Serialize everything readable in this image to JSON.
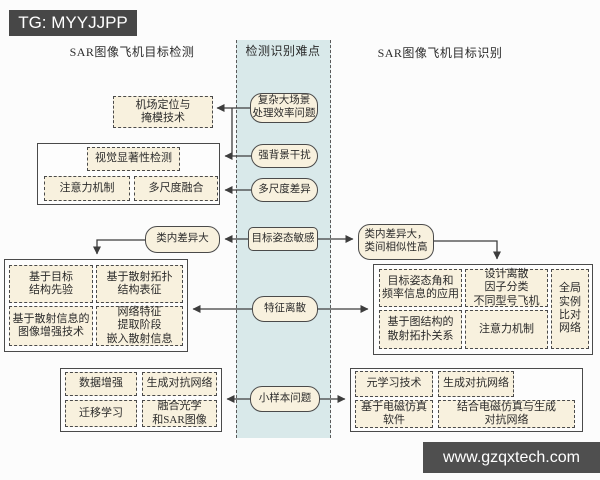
{
  "colors": {
    "strip_bg": "#d9e9ea",
    "box_fill": "#f8f1de",
    "border": "#4a4a4a",
    "banner_bg": "#474747",
    "page_bg": "#fcfcfc"
  },
  "banners": {
    "top_left": "TG: MYYJJPP",
    "bottom_right": "www.gzqxtech.com"
  },
  "headers": {
    "left": "SAR图像飞机目标检测",
    "middle": "检测识别难点",
    "right": "SAR图像飞机目标识别"
  },
  "difficulties": {
    "complex_scene": "复杂大场景\n处理效率问题",
    "strong_background": "强背景干扰",
    "multiscale_difference": "多尺度差异",
    "pose_sensitivity": "目标姿态敏感",
    "feature_dispersion": "特征离散",
    "small_sample": "小样本问题"
  },
  "detection": {
    "airport_masking": "机场定位与\n掩模技术",
    "saliency_group": {
      "title": "视觉显著性检测",
      "attention": "注意力机制",
      "multiscale_fusion": "多尺度融合"
    },
    "intra_class_variance": "类内差异大",
    "structure_group": {
      "target_prior": "基于目标\n结构先验",
      "scattering_topology": "基于散射拓扑\n结构表征",
      "image_enhancement": "基于散射信息的\n图像增强技术",
      "network_embedding": "网络特征\n提取阶段\n嵌入散射信息"
    },
    "small_sample_group": {
      "data_augmentation": "数据增强",
      "gan": "生成对抗网络",
      "transfer_learning": "迁移学习",
      "optical_sar_fusion": "融合光学\n和SAR图像"
    }
  },
  "recognition": {
    "intra_inter_class": "类内差异大，\n类间相似性高",
    "feature_group": {
      "pose_frequency": "目标姿态角和\n频率信息的应用",
      "dispersion_factor": "设计离散\n因子分类\n不同型号飞机",
      "graph_topology": "基于图结构的\n散射拓扑关系",
      "attention": "注意力机制",
      "global_instance": "全局\n实例\n比对\n网络"
    },
    "small_sample_group": {
      "meta_learning": "元学习技术",
      "gan": "生成对抗网络",
      "em_simulation": "基于电磁仿真\n软件",
      "em_gan": "结合电磁仿真与生成\n对抗网络"
    }
  }
}
